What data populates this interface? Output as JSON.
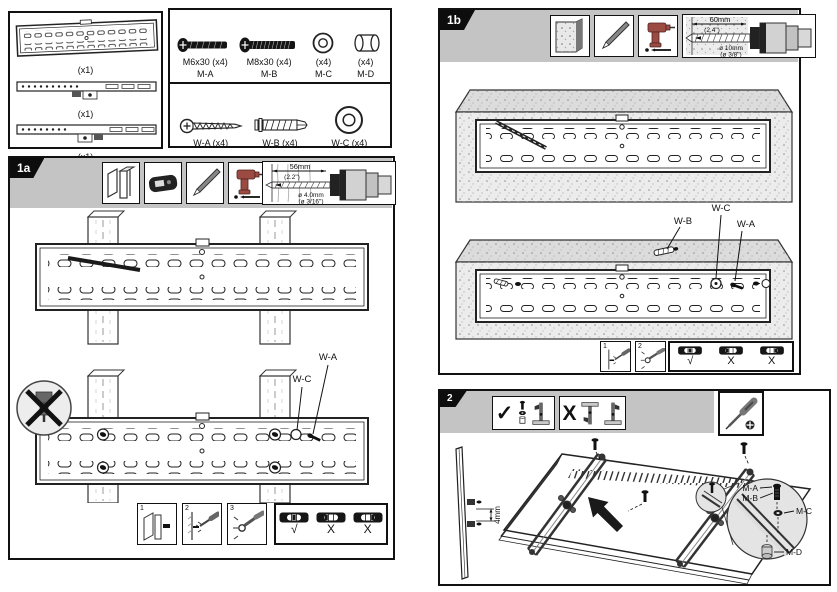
{
  "colors": {
    "line": "#1a1a1a",
    "header_gray": "#c4c4c4",
    "tab_black": "#0d0d0d",
    "concrete_light": "#ececec",
    "drill_red": "#9c4b42"
  },
  "parts_box": {
    "items": [
      {
        "name": "wall-plate",
        "qty": "(x1)"
      },
      {
        "name": "tv-bracket-a",
        "qty": "(x1)"
      },
      {
        "name": "tv-bracket-b",
        "qty": "(x1)"
      }
    ]
  },
  "hardware_box": {
    "row1": [
      {
        "size": "M6x30 (x4)",
        "code": "M-A"
      },
      {
        "size": "M8x30 (x4)",
        "code": "M-B"
      },
      {
        "size": "(x4)",
        "code": "M-C"
      },
      {
        "size": "(x4)",
        "code": "M-D"
      }
    ],
    "row2": [
      {
        "code": "W-A (x4)"
      },
      {
        "code": "W-B (x4)"
      },
      {
        "code": "W-C (x4)"
      }
    ]
  },
  "panel_1a": {
    "id": "1a",
    "drill": {
      "depth": "56mm",
      "depth_in": "(2.2\")",
      "dia": "ø 4.0mm",
      "dia_in": "(ø 3/16\")"
    },
    "callouts": {
      "wa": "W-A",
      "wc": "W-C"
    },
    "steps": [
      "1",
      "2",
      "3"
    ],
    "level_marks": [
      "√",
      "X",
      "X"
    ]
  },
  "panel_1b": {
    "id": "1b",
    "drill": {
      "depth": "60mm",
      "depth_in": "(2.4\")",
      "dia": "ø 10mm",
      "dia_in": "(ø 3/8\")"
    },
    "callouts": {
      "wb": "W-B",
      "wc": "W-C",
      "wa": "W-A"
    },
    "steps": [
      "1",
      "2"
    ],
    "level_marks": [
      "√",
      "X",
      "X"
    ]
  },
  "panel_2": {
    "id": "2",
    "ok_mark": "✓",
    "no_mark": "X",
    "gap": "4mm",
    "callouts": {
      "ma": "M-A",
      "mb": "M-B",
      "mc": "M-C",
      "md": "M-D"
    }
  }
}
